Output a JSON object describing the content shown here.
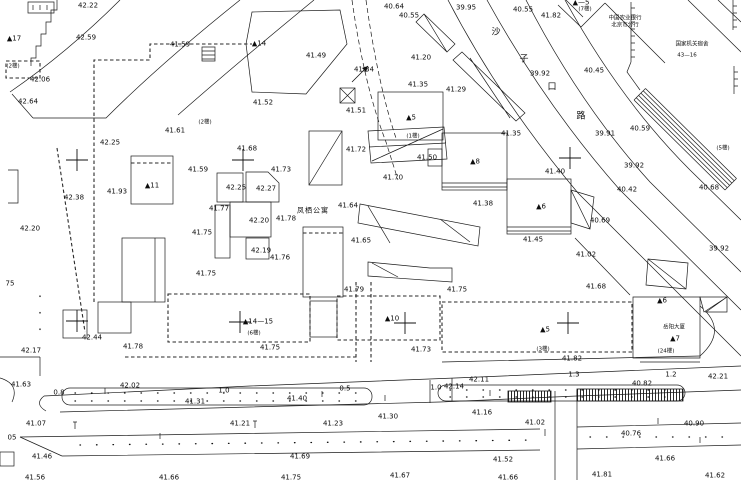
{
  "map": {
    "kind": "cadastral-survey-map",
    "street_name": "沙子口路",
    "apartment_name": "凤栖公寓",
    "bank_name_lines": [
      "中国农业银行",
      "北京市分行"
    ],
    "office_lines": [
      "国家机关宿舍",
      "43—16"
    ],
    "tower_name": "岳阳大厦",
    "labels": [
      [
        "42.22",
        88,
        6,
        "e"
      ],
      [
        "42.59",
        86,
        38,
        "e"
      ],
      [
        "42.06",
        40,
        80,
        "e"
      ],
      [
        "42.64",
        28,
        102,
        "e"
      ],
      [
        "42.25",
        110,
        143,
        "e"
      ],
      [
        "42.38",
        74,
        198,
        "e"
      ],
      [
        "41.93",
        117,
        192,
        "e"
      ],
      [
        "42.20",
        30,
        229,
        "e"
      ],
      [
        "41.59",
        180,
        45,
        "e"
      ],
      [
        "41.61",
        175,
        131,
        "e"
      ],
      [
        "41.52",
        263,
        103,
        "e"
      ],
      [
        "41.49",
        316,
        56,
        "e"
      ],
      [
        "41.51",
        356,
        111,
        "e"
      ],
      [
        "41.34",
        364,
        70,
        "e"
      ],
      [
        "40.64",
        394,
        7,
        "e"
      ],
      [
        "40.55",
        409,
        16,
        "e"
      ],
      [
        "39.95",
        466,
        8,
        "e"
      ],
      [
        "40.55",
        523,
        10,
        "e"
      ],
      [
        "41.82",
        551,
        16,
        "e"
      ],
      [
        "39.92",
        540,
        74,
        "e"
      ],
      [
        "40.45",
        594,
        71,
        "e"
      ],
      [
        "41.20",
        421,
        58,
        "e"
      ],
      [
        "41.35",
        418,
        85,
        "e"
      ],
      [
        "41.29",
        456,
        90,
        "e"
      ],
      [
        "41.35",
        511,
        134,
        "e"
      ],
      [
        "41.68",
        247,
        149,
        "e"
      ],
      [
        "41.59",
        198,
        170,
        "e"
      ],
      [
        "42.25",
        236,
        188,
        "e"
      ],
      [
        "42.27",
        266,
        189,
        "e"
      ],
      [
        "41.73",
        281,
        170,
        "e"
      ],
      [
        "41.77",
        219,
        209,
        "e"
      ],
      [
        "42.20",
        259,
        221,
        "e"
      ],
      [
        "41.78",
        286,
        219,
        "e"
      ],
      [
        "41.75",
        202,
        233,
        "e"
      ],
      [
        "42.19",
        261,
        251,
        "e"
      ],
      [
        "41.76",
        280,
        258,
        "e"
      ],
      [
        "41.75",
        206,
        274,
        "e"
      ],
      [
        "41.72",
        356,
        150,
        "e"
      ],
      [
        "41.50",
        427,
        158,
        "e"
      ],
      [
        "41.70",
        393,
        178,
        "e"
      ],
      [
        "41.64",
        348,
        206,
        "e"
      ],
      [
        "41.65",
        361,
        241,
        "e"
      ],
      [
        "41.79",
        354,
        290,
        "e"
      ],
      [
        "41.75",
        457,
        290,
        "e"
      ],
      [
        "41.40",
        555,
        172,
        "e"
      ],
      [
        "41.38",
        483,
        204,
        "e"
      ],
      [
        "41.45",
        533,
        240,
        "e"
      ],
      [
        "40.69",
        600,
        221,
        "e"
      ],
      [
        "41.02",
        586,
        255,
        "e"
      ],
      [
        "41.68",
        596,
        287,
        "e"
      ],
      [
        "40.59",
        640,
        129,
        "e"
      ],
      [
        "39.91",
        605,
        134,
        "e"
      ],
      [
        "39.92",
        634,
        166,
        "e"
      ],
      [
        "40.42",
        627,
        190,
        "e"
      ],
      [
        "40.68",
        709,
        188,
        "e"
      ],
      [
        "39.92",
        719,
        249,
        "e"
      ],
      [
        "42.17",
        31,
        351,
        "e"
      ],
      [
        "42.44",
        92,
        338,
        "e"
      ],
      [
        "41.78",
        133,
        347,
        "e"
      ],
      [
        "41.75",
        270,
        348,
        "e"
      ],
      [
        "41.73",
        421,
        350,
        "e"
      ],
      [
        "41.82",
        572,
        359,
        "e"
      ],
      [
        "41.63",
        21,
        385,
        "e"
      ],
      [
        "42.02",
        130,
        386,
        "e"
      ],
      [
        "41.31",
        195,
        402,
        "e"
      ],
      [
        "41.40",
        297,
        399,
        "e"
      ],
      [
        "41.30",
        388,
        417,
        "e"
      ],
      [
        "41.16",
        482,
        413,
        "e"
      ],
      [
        "42.14",
        454,
        387,
        "e"
      ],
      [
        "42.11",
        479,
        380,
        "e"
      ],
      [
        "40.82",
        642,
        384,
        "e"
      ],
      [
        "42.21",
        718,
        377,
        "e"
      ],
      [
        "41.07",
        36,
        424,
        "e"
      ],
      [
        "41.21",
        240,
        424,
        "e"
      ],
      [
        "41.23",
        333,
        424,
        "e"
      ],
      [
        "41.02",
        535,
        423,
        "e"
      ],
      [
        "40.90",
        694,
        424,
        "e"
      ],
      [
        "40.76",
        631,
        434,
        "e"
      ],
      [
        "41.46",
        42,
        457,
        "e"
      ],
      [
        "41.69",
        300,
        457,
        "e"
      ],
      [
        "41.52",
        503,
        460,
        "e"
      ],
      [
        "41.66",
        665,
        459,
        "e"
      ],
      [
        "41.56",
        35,
        478,
        "e"
      ],
      [
        "41.66",
        169,
        478,
        "e"
      ],
      [
        "41.75",
        291,
        478,
        "e"
      ],
      [
        "41.67",
        400,
        476,
        "e"
      ],
      [
        "41.66",
        508,
        478,
        "e"
      ],
      [
        "41.81",
        602,
        475,
        "e"
      ],
      [
        "41.62",
        715,
        476,
        "e"
      ],
      [
        "0.8",
        59,
        393,
        "w"
      ],
      [
        "1.0",
        224,
        391,
        "w"
      ],
      [
        "0.5",
        345,
        389,
        "w"
      ],
      [
        "1.0",
        436,
        388,
        "w"
      ],
      [
        "1.3",
        574,
        375,
        "w"
      ],
      [
        "1.2",
        671,
        375,
        "w"
      ],
      [
        "▲17",
        14,
        39,
        "b"
      ],
      [
        "▲14",
        259,
        44,
        "b"
      ],
      [
        "▲11",
        152,
        186,
        "b"
      ],
      [
        "▲5",
        411,
        118,
        "b"
      ],
      [
        "▲8",
        475,
        162,
        "b"
      ],
      [
        "▲6",
        541,
        207,
        "b"
      ],
      [
        "▲14—15",
        258,
        322,
        "b"
      ],
      [
        "▲10",
        392,
        319,
        "b"
      ],
      [
        "▲5",
        545,
        330,
        "b"
      ],
      [
        "▲6",
        662,
        301,
        "b"
      ],
      [
        "▲—5",
        581,
        3,
        "b"
      ],
      [
        "▲7",
        675,
        339,
        "b"
      ],
      [
        "(2楼)",
        13,
        67,
        "f"
      ],
      [
        "(2楼)",
        205,
        123,
        "f"
      ],
      [
        "(1楼)",
        413,
        137,
        "f"
      ],
      [
        "(7楼)",
        585,
        10,
        "f"
      ],
      [
        "(6楼)",
        254,
        334,
        "f"
      ],
      [
        "(3楼)",
        543,
        350,
        "f"
      ],
      [
        "(24楼)",
        666,
        352,
        "f"
      ],
      [
        "(5楼)",
        723,
        149,
        "f"
      ],
      [
        "凤栖公寓",
        313,
        211,
        "n"
      ],
      [
        "岳阳大厦",
        674,
        328,
        "ns"
      ],
      [
        "中国农业银行",
        625,
        19,
        "ns"
      ],
      [
        "北京市分行",
        625,
        26,
        "ns"
      ],
      [
        "国家机关宿舍",
        692,
        45,
        "ns"
      ],
      [
        "43—16",
        687,
        56,
        "ns"
      ],
      [
        "沙",
        496,
        33,
        "s"
      ],
      [
        "子",
        524,
        60,
        "s"
      ],
      [
        "口",
        552,
        88,
        "s"
      ],
      [
        "路",
        581,
        117,
        "s"
      ],
      [
        "05",
        12,
        438,
        "p"
      ],
      [
        "75",
        10,
        284,
        "p"
      ]
    ]
  }
}
